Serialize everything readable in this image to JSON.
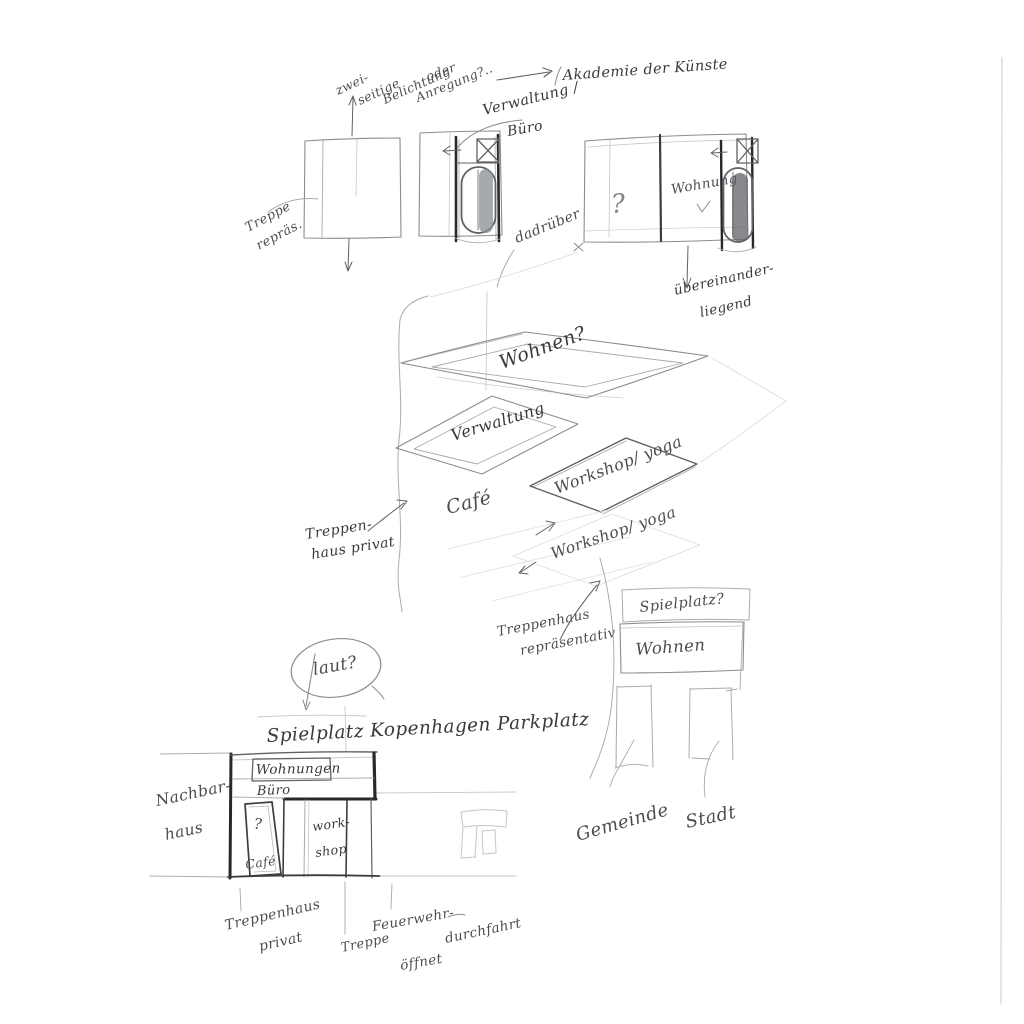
{
  "sketch": {
    "medium": "pencil on paper",
    "top": {
      "note_zwei": "zwei-",
      "note_seitige": "seitige",
      "note_belichtung": "Belichtung",
      "note_oder": "oder",
      "note_anregung": "Anregung?..",
      "treppe_repraes_1": "Treppe",
      "treppe_repraes_2": "repräs.",
      "verwaltung_buero_1": "Verwaltung /",
      "verwaltung_buero_2": "Büro",
      "akademie": "Akademie der Künste",
      "dadrueber": "dadrüber",
      "question_mark": "?",
      "wohnung": "Wohnung",
      "uebereinander_1": "übereinander-",
      "uebereinander_2": "liegend"
    },
    "middle": {
      "wohnen": "Wohnen?",
      "verwaltung": "Verwaltung",
      "cafe": "Café",
      "workshop_yoga_1": "Workshop/ yoga",
      "workshop_yoga_2": "Workshop/ yoga",
      "treppenhaus_privat_1": "Treppen-",
      "treppenhaus_privat_2": "haus privat",
      "treppenhaus_repr_1": "Treppenhaus",
      "treppenhaus_repr_2": "repräsentativ"
    },
    "right_block": {
      "spielplatz": "Spielplatz?",
      "wohnen": "Wohnen"
    },
    "bottom": {
      "laut": "laut?",
      "heading": "Spielplatz Kopenhagen Parkplatz",
      "nachbar_1": "Nachbar-",
      "nachbar_2": "haus",
      "wohnungen": "Wohnungen",
      "buero": "Büro",
      "question_mark": "?",
      "cafe": "Café",
      "work_1": "work-",
      "work_2": "shop",
      "treppenhaus_1": "Treppenhaus",
      "treppenhaus_2": "privat",
      "treppe": "Treppe",
      "feuerwehr": "Feuerwehr-",
      "oeffnet": "öffnet",
      "durchfahrt": "durchfahrt",
      "gemeinde": "Gemeinde",
      "stadt": "Stadt"
    },
    "colors": {
      "paper": "#ffffff",
      "pencil_faint": "#dcdedf",
      "pencil_light": "#a8abad",
      "pencil_mid": "#8a8d90",
      "pencil_dark": "#3b3d40",
      "pencil_heavy": "#26282a",
      "ink_text": "#37393c"
    }
  }
}
